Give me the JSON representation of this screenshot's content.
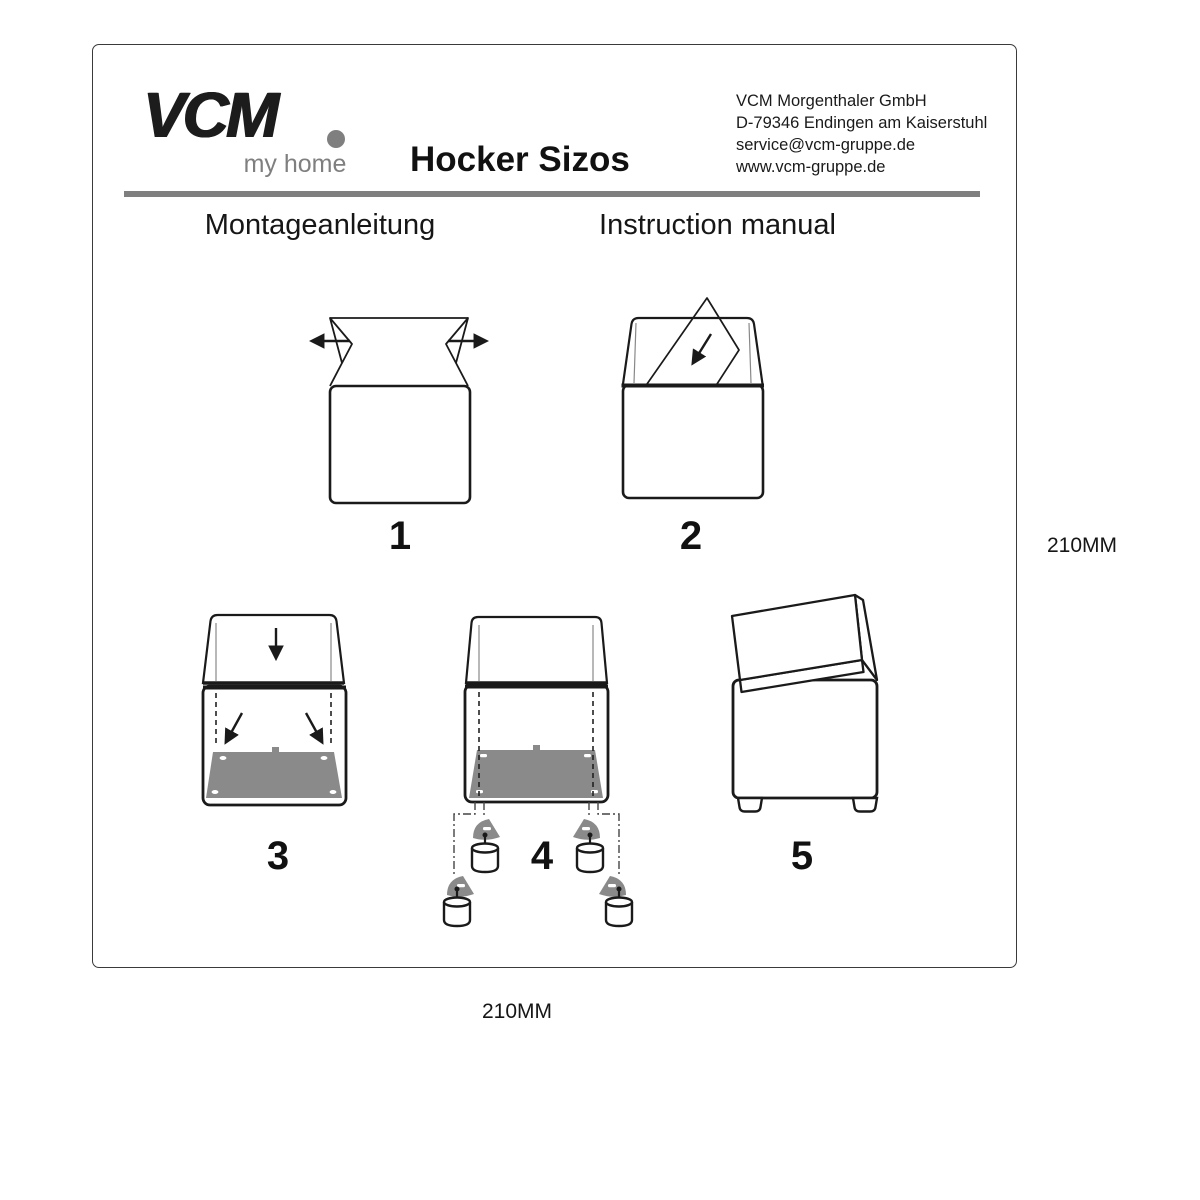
{
  "header": {
    "logo": {
      "brand": "VCM",
      "tagline": "my home"
    },
    "title": "Hocker Sizos",
    "company": {
      "name": "VCM Morgenthaler GmbH",
      "address": "D-79346 Endingen am Kaiserstuhl",
      "email": "service@vcm-gruppe.de",
      "website": "www.vcm-gruppe.de"
    }
  },
  "headings": {
    "german": "Montageanleitung",
    "english": "Instruction manual"
  },
  "steps": [
    {
      "number": "1",
      "diagram": "open-box-flaps-outward"
    },
    {
      "number": "2",
      "diagram": "insert-panel-into-box"
    },
    {
      "number": "3",
      "diagram": "press-bottom-board-down"
    },
    {
      "number": "4",
      "diagram": "attach-brackets-and-feet"
    },
    {
      "number": "5",
      "diagram": "assembled-stool-with-lid"
    }
  ],
  "dimensions": {
    "right": "210MM",
    "bottom": "210MM"
  },
  "colors": {
    "accent_gray": "#7f7f7f",
    "panel_gray": "#8a8a8a",
    "line_black": "#1a1a1a"
  }
}
